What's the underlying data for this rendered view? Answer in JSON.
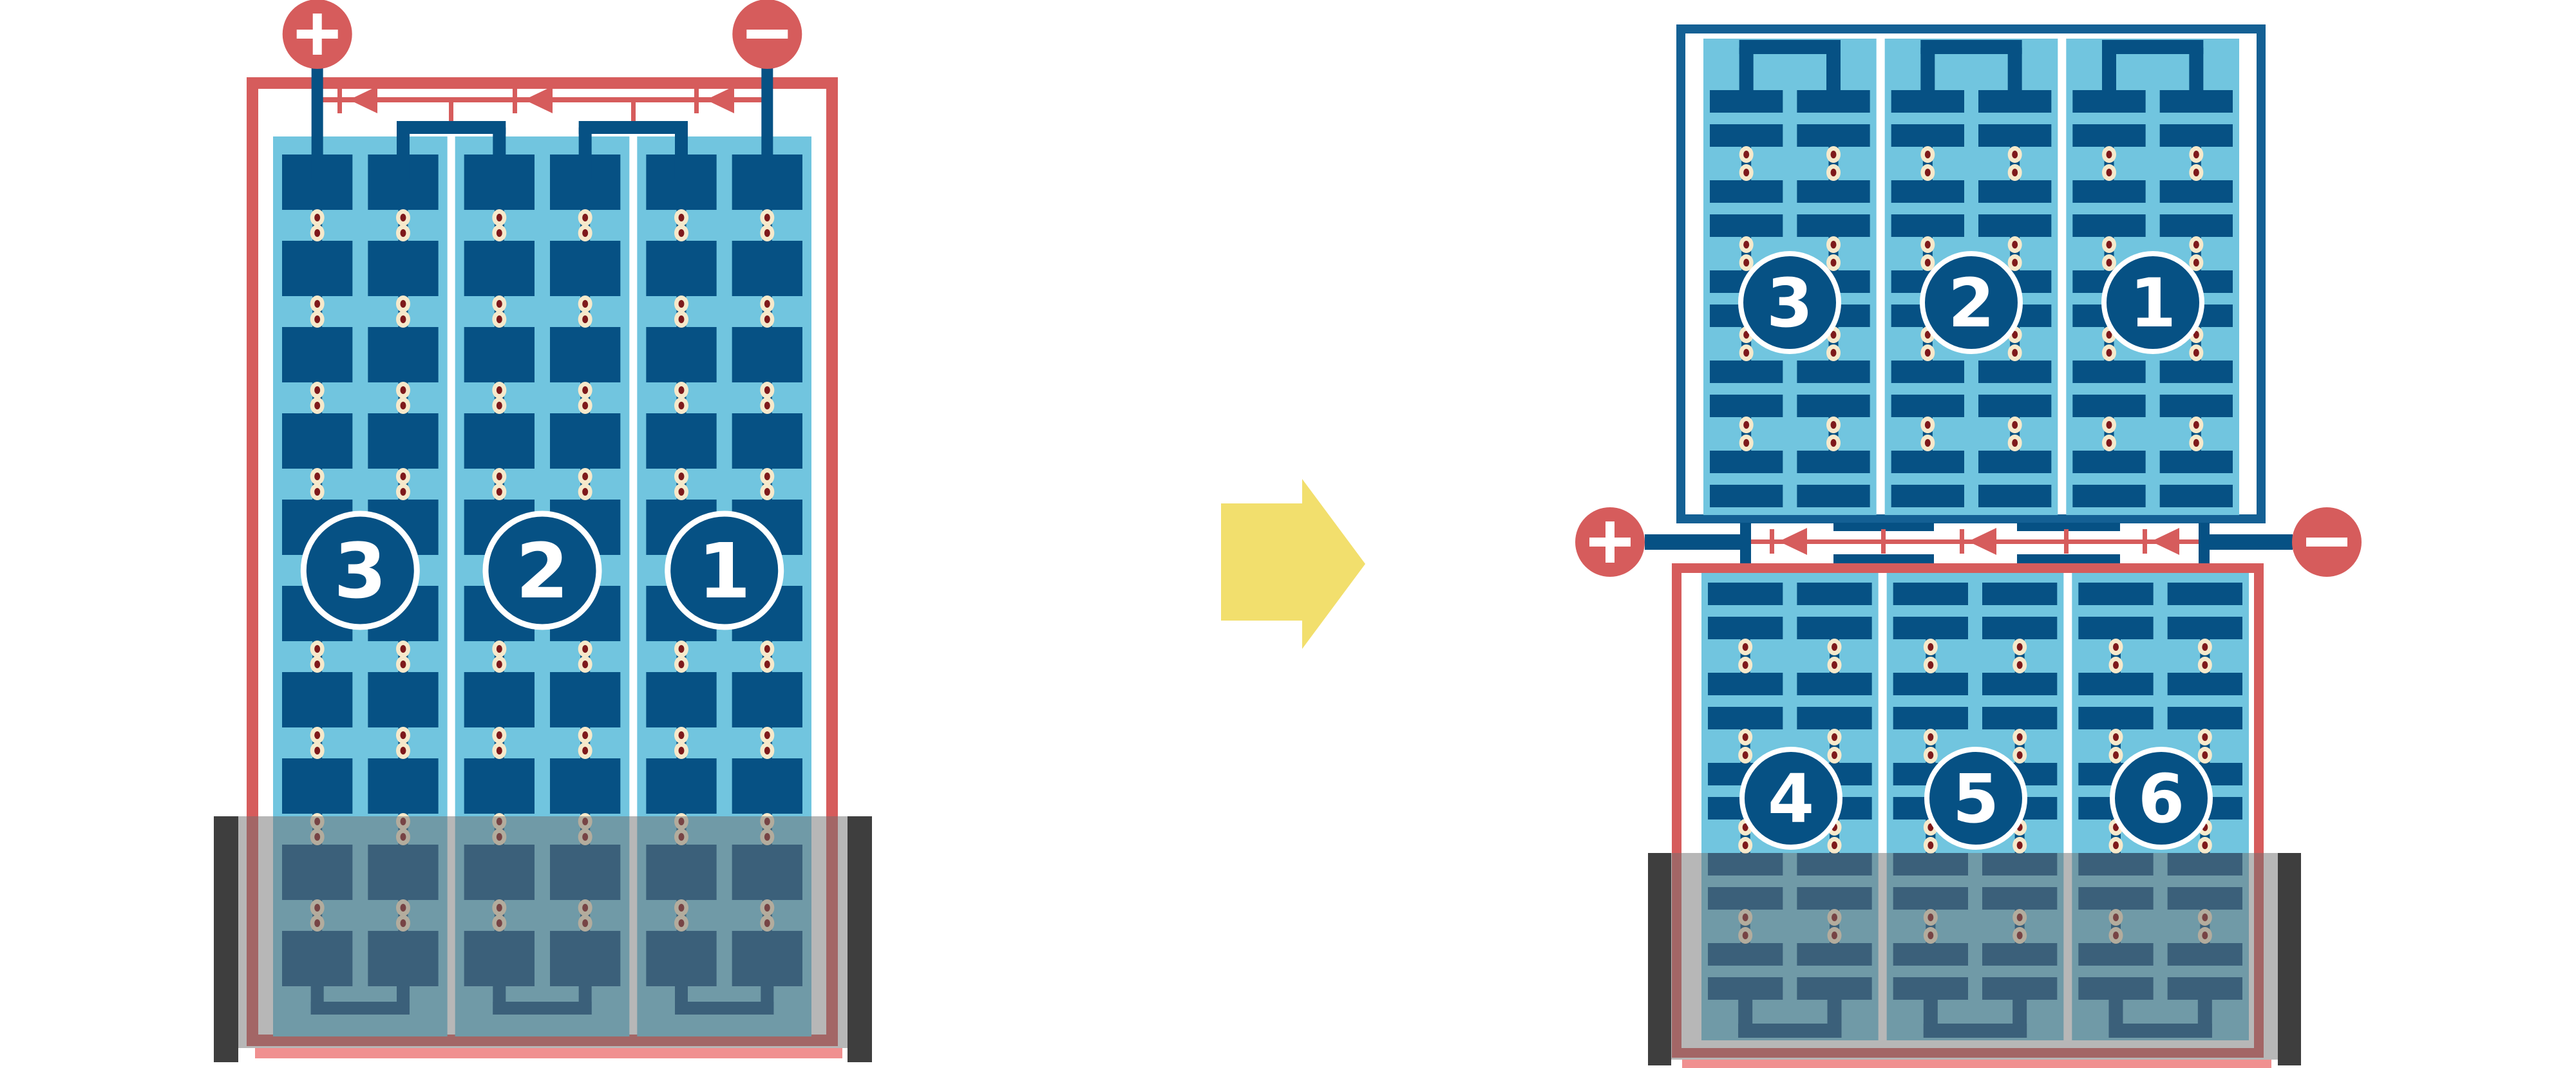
{
  "title": "battery-cell series connection rearrangement diagram",
  "colors": {
    "red": "#D65C5C",
    "pink_shadow": "#F09090",
    "navy": "#065184",
    "frame_blue": "#146094",
    "light_blue": "#71C5DF",
    "cream": "#F6E9CB",
    "dot_red": "#7E191B",
    "white": "#FFFFFF",
    "tray_gray": "#707070",
    "tray_bar": "#3E3E3E",
    "arrow_yellow": "#F2DF6D"
  },
  "left_battery": {
    "positive_terminal": "+",
    "negative_terminal": "−",
    "cells": [
      {
        "label": "3"
      },
      {
        "label": "2"
      },
      {
        "label": "1"
      }
    ]
  },
  "transform_arrow": {
    "direction": "right"
  },
  "right_battery": {
    "positive_terminal": "+",
    "negative_terminal": "−",
    "top_module": {
      "cells": [
        {
          "label": "3"
        },
        {
          "label": "2"
        },
        {
          "label": "1"
        }
      ]
    },
    "bottom_module": {
      "cells": [
        {
          "label": "4"
        },
        {
          "label": "5"
        },
        {
          "label": "6"
        }
      ]
    }
  }
}
